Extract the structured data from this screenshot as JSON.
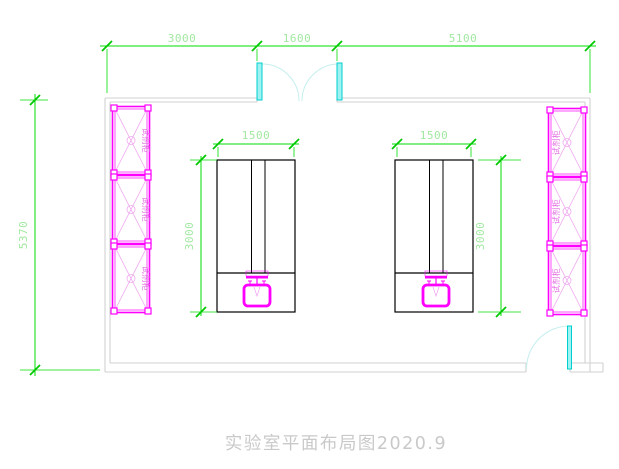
{
  "drawing": {
    "title": "实验室平面布局图2020.9",
    "room": {
      "dim_top_left": "3000",
      "dim_top_door": "1600",
      "dim_top_right": "5100",
      "dim_left_height": "5370"
    },
    "benches": {
      "left": {
        "width_label": "1500",
        "depth_label": "3000"
      },
      "right": {
        "width_label": "1500",
        "depth_label": "3000"
      }
    },
    "cabinets": {
      "left": [
        "试剂柜",
        "试剂柜",
        "试剂柜"
      ],
      "right": [
        "试剂柜",
        "试剂柜",
        "试剂柜"
      ]
    },
    "colors": {
      "dimension_green": "#00dd00",
      "dimension_text_green": "#a2e8a2",
      "cabinet_magenta": "#ff00ff",
      "door_cyan": "#00cfcf",
      "wall_gray": "#d2d2d2",
      "bench_black": "#000000",
      "title_gray": "#c9c9c9"
    }
  }
}
